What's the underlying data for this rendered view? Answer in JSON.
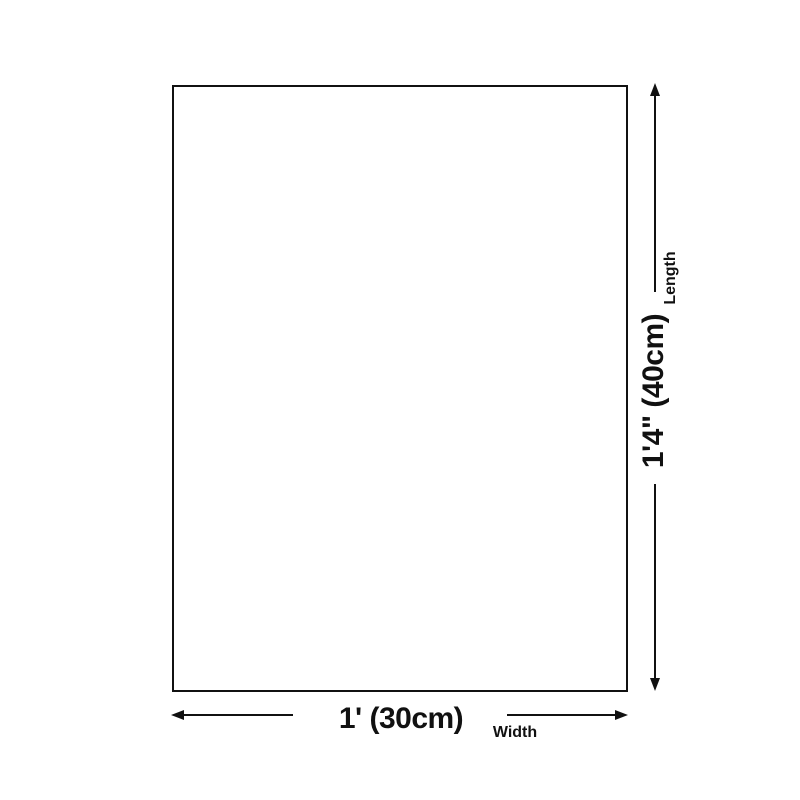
{
  "colors": {
    "ink": "#111111",
    "background": "#ffffff"
  },
  "diagram": {
    "length": {
      "value": "1'4\" (40cm)",
      "label": "Length"
    },
    "width": {
      "value": "1' (30cm)",
      "label": "Width"
    }
  }
}
